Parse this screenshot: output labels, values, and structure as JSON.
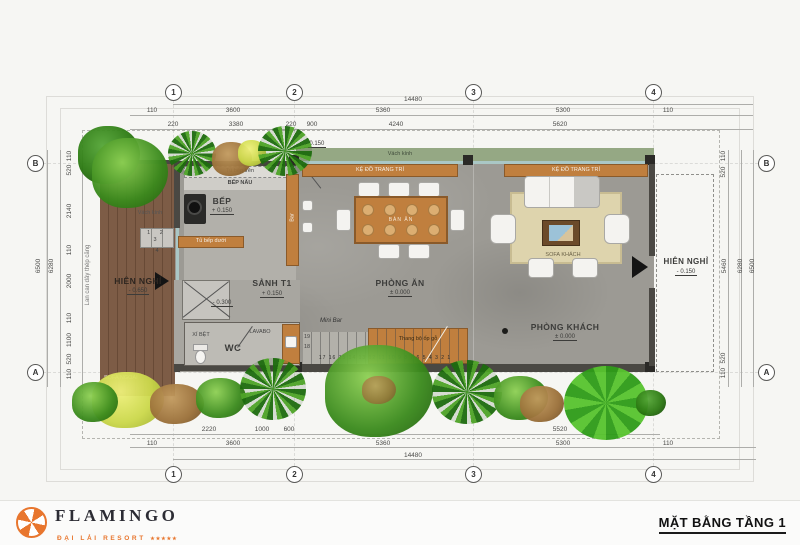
{
  "palette": {
    "accent_orange": "#E8762E",
    "wood": "#C07F3E",
    "deck_brown": "#7B5B45",
    "glass_green": "#95A884",
    "concrete": "#9C9A94",
    "rug": "#DED4AD",
    "wall_dark": "#4A4843",
    "plant_green": "#3A8A1C"
  },
  "sheet": {
    "plan_title": "MẶT BẰNG TẦNG 1"
  },
  "logo": {
    "brand": "FLAMINGO",
    "subtitle": "ĐẠI LẢI RESORT",
    "stars": "★★★★★"
  },
  "grid": {
    "col_1": "1",
    "col_2": "2",
    "col_3": "3",
    "col_4": "4",
    "row_a": "A",
    "row_b": "B"
  },
  "dims": {
    "top_total": "14480",
    "top_row2": [
      "110",
      "3600",
      "5360",
      "5300",
      "110"
    ],
    "top_row3": [
      "220",
      "3380",
      "220",
      "900",
      "4240",
      "5620"
    ],
    "bottom_row1": [
      "2220",
      "1000",
      "600",
      "5520"
    ],
    "bottom_row2": [
      "110",
      "3600",
      "5360",
      "5300",
      "110"
    ],
    "bottom_total": "14480",
    "left_totals": [
      "6500",
      "6280"
    ],
    "left_segments": [
      "110",
      "520",
      "2140",
      "110",
      "2000",
      "110",
      "1100",
      "520",
      "110"
    ],
    "right_totals": [
      "6500",
      "6280"
    ],
    "right_segments": [
      "110",
      "520",
      "5460",
      "520",
      "110"
    ]
  },
  "rooms": [
    {
      "name": "BẾP",
      "elev": "+ 0.150"
    },
    {
      "name": "SẢNH T1",
      "elev": "+ 0.150"
    },
    {
      "name": "PHÒNG ĂN",
      "elev": "± 0.000"
    },
    {
      "name": "PHÒNG KHÁCH",
      "elev": "± 0.000"
    },
    {
      "name": "HIÊN NGHỈ",
      "elev": "- 0.650"
    },
    {
      "name": "HIÊN NGHỈ",
      "elev": "- 0.150"
    },
    {
      "name": "WC"
    },
    {
      "name": "LAVABO"
    },
    {
      "name": "XÍ BỆT"
    }
  ],
  "labels": {
    "tu_bep_tren": "Tủ bếp trên",
    "bep_nau": "BẾP NẤU",
    "tu_bep_duoi": "Tủ bếp dưới",
    "bar": "Bar",
    "mini_bar": "Mini Bar",
    "vach_kinh": "Vách kính",
    "ke_do_trang_tri": "KỆ ĐỒ TRANG TRÍ",
    "sofa_khach": "SOFA KHÁCH",
    "sofa_ngoai": "SOFA NGOÀI",
    "lan_can": "Lan can dây thép căng",
    "ban_an": "BÀN ĂN",
    "thang_go": "Thang bộ ốp gỗ",
    "door_elev": "- 0.150",
    "entry_elev": "- 0.300",
    "stair_treads": "17 16 15 14 13 12 11 10 9 8 7 6 5 4 3 2 1",
    "stair_19": "19",
    "stair_18": "18",
    "deck_steps": "1 2 3",
    "deck_step4": "4"
  }
}
